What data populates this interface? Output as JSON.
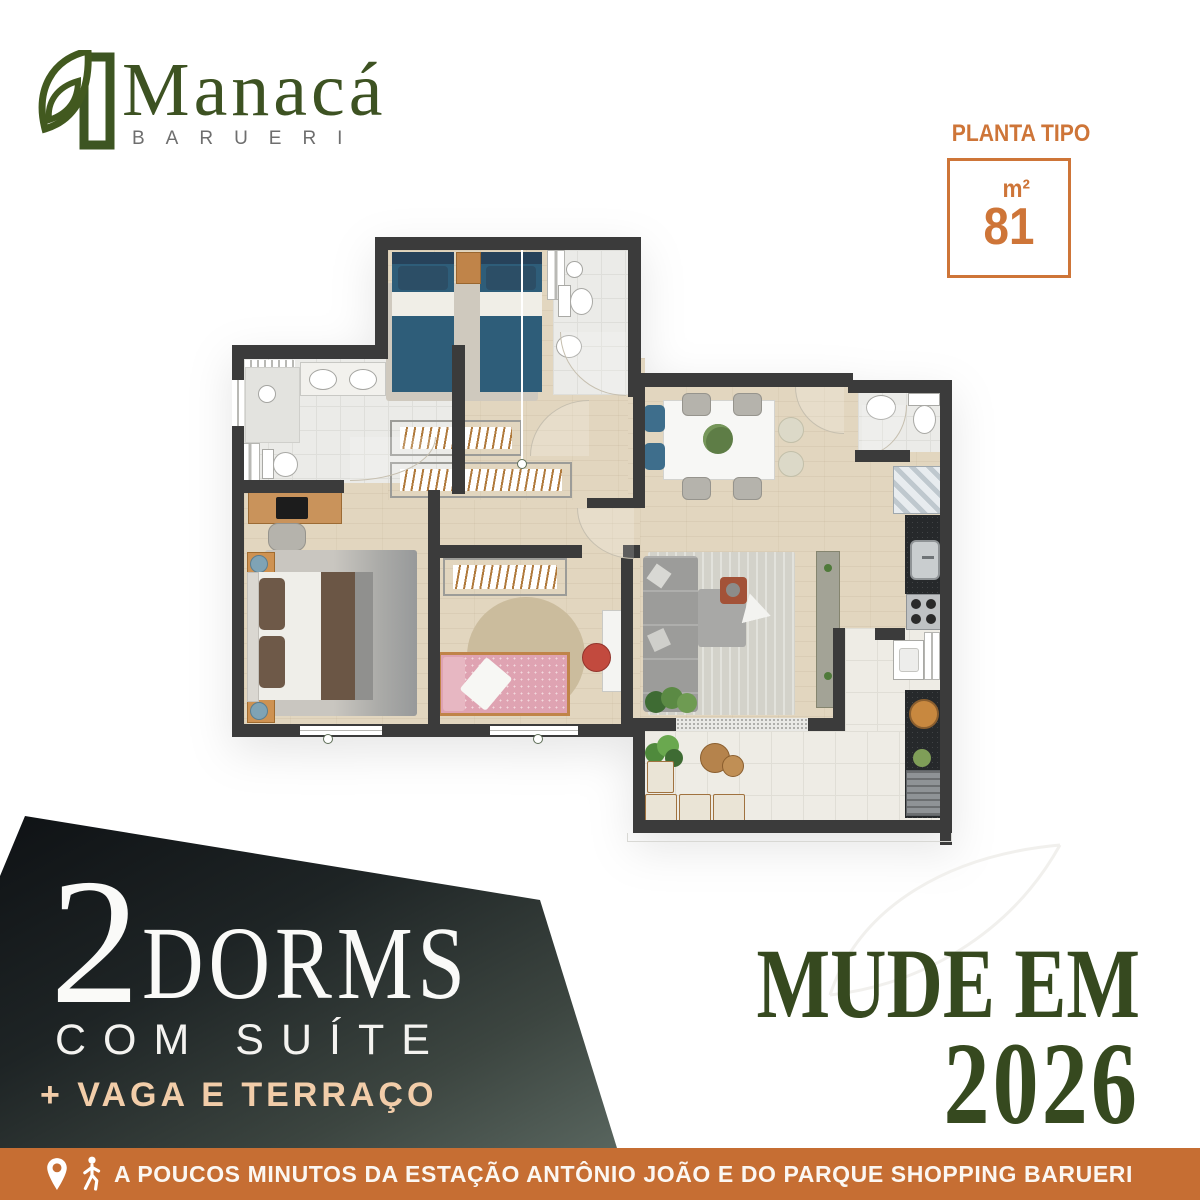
{
  "brand": {
    "name": "Manacá",
    "city": "BARUERI"
  },
  "plan_badge": {
    "label": "PLANTA TIPO",
    "unit": "m²",
    "area": "81"
  },
  "offer": {
    "quantity": "2",
    "type": "DORMS",
    "feature": "COM SUÍTE",
    "extras": "+ VAGA E TERRAÇO"
  },
  "cta": {
    "line1": "MUDE EM",
    "line2": "2026"
  },
  "footer": {
    "message": "A POUCOS MINUTOS DA ESTAÇÃO ANTÔNIO JOÃO E DO PARQUE SHOPPING BARUERI"
  },
  "icons": {
    "logo": "leaf-logo",
    "location": "location-pin",
    "walking": "walking-person"
  },
  "colors": {
    "orange_bar": "#C66E33",
    "orange_accent": "#CE7538",
    "logo_green": "#3D5222",
    "cta_green": "#36491F",
    "peach": "#F2CDA9",
    "panel_dark": "#0E1114",
    "panel_light": "#5C6962",
    "wall": "#3B3B3B",
    "wood_floor": "#E2D6BF"
  }
}
